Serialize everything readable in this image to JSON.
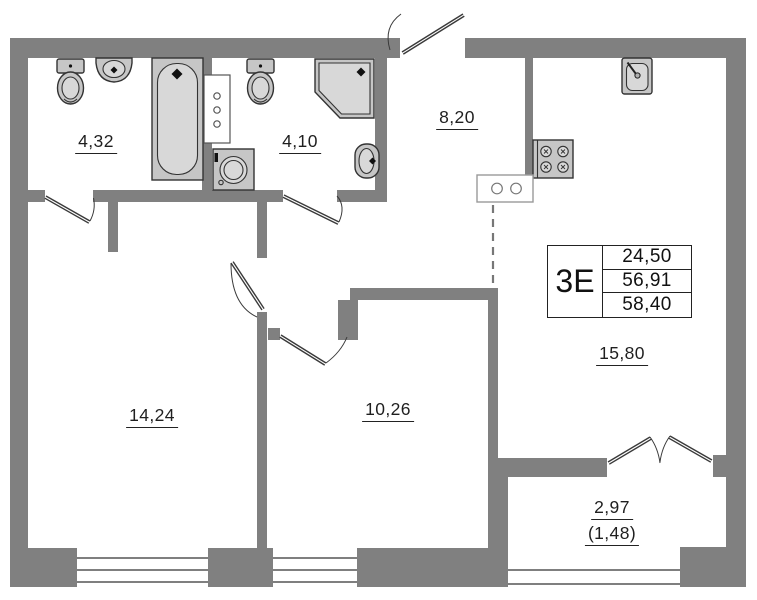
{
  "plan": {
    "title": "apartment floor plan",
    "info_table": {
      "apartment_type": "3Е",
      "living_area": "24,50",
      "total_area": "56,91",
      "total_area_with_balcony": "58,40"
    },
    "rooms": [
      {
        "id": "bathroom-1",
        "area": "4,32"
      },
      {
        "id": "bathroom-2",
        "area": "4,10"
      },
      {
        "id": "hallway",
        "area": "8,20"
      },
      {
        "id": "room-1",
        "area": "14,24"
      },
      {
        "id": "room-2",
        "area": "10,26"
      },
      {
        "id": "kitchen-living",
        "area": "15,80"
      },
      {
        "id": "balcony",
        "area": "2,97",
        "area_with_coefficient": "(1,48)"
      }
    ],
    "fixtures": [
      "toilet",
      "wall-sink",
      "bathtub",
      "ventilation-shaft",
      "washing-machine",
      "toilet",
      "corner-shower",
      "oval-sink",
      "kitchen-sink",
      "stove",
      "counter"
    ]
  },
  "colors": {
    "wall": "#808080",
    "fixture_fill": "#c6c6c6",
    "fixture_fill_light": "#d8d8d8",
    "outline": "#333333",
    "text": "#1f1f1f",
    "window_line": "#555555"
  }
}
